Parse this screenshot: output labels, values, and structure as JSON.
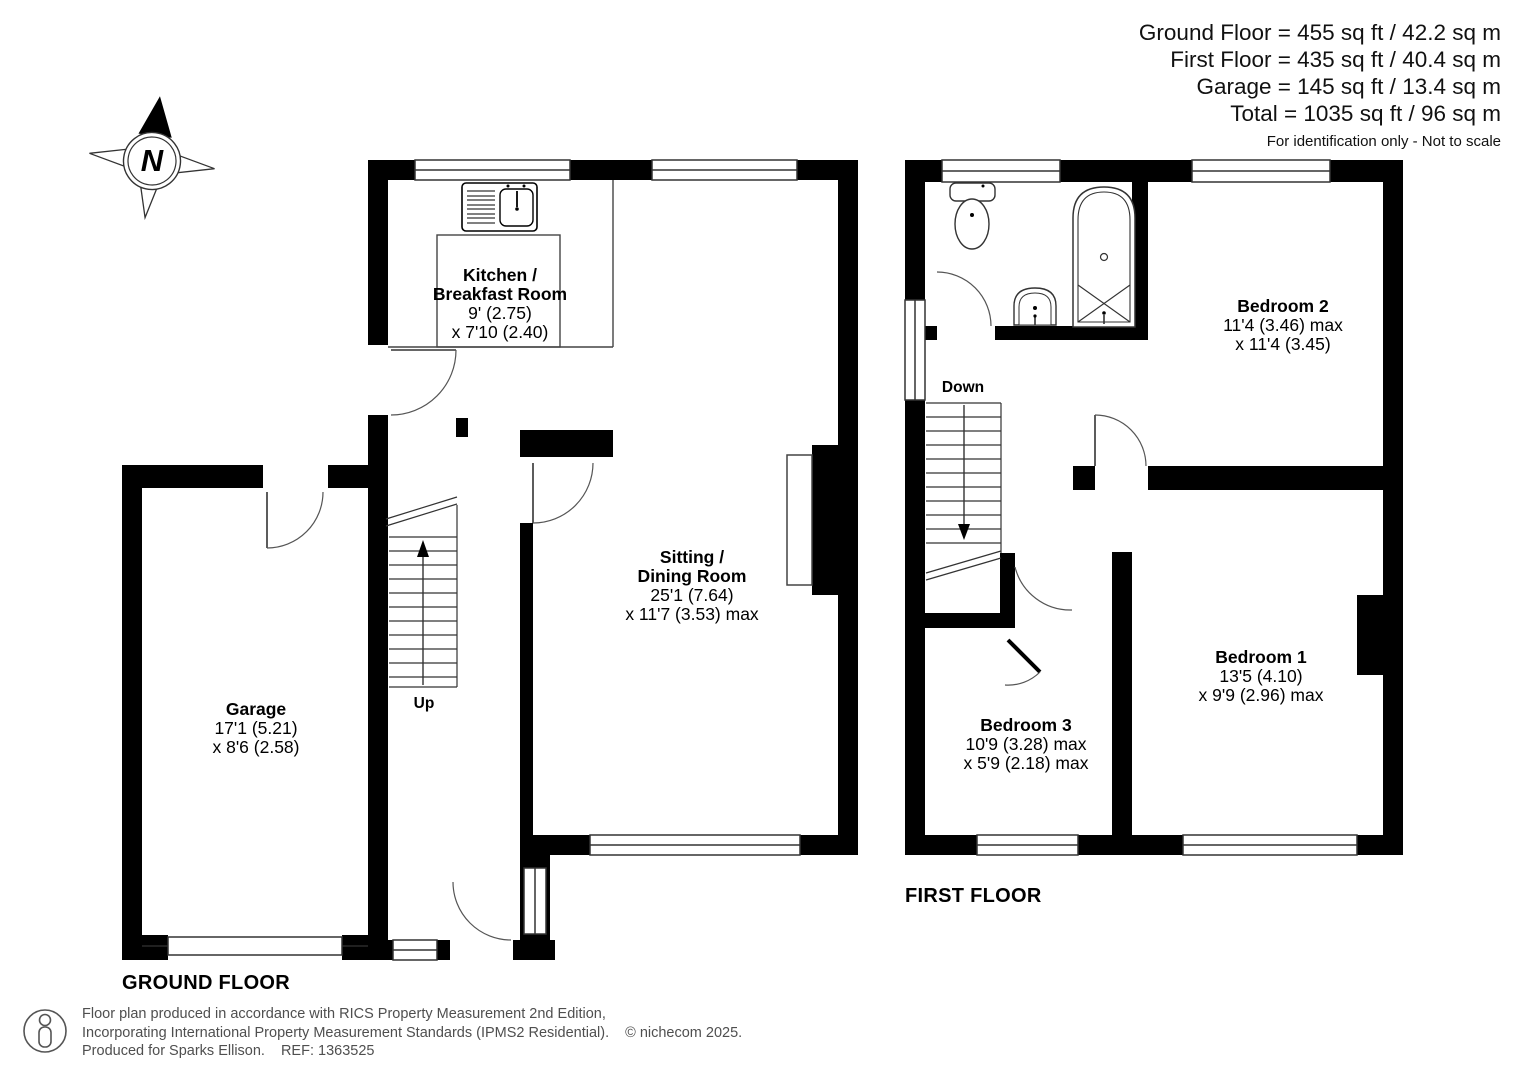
{
  "header": {
    "area_lines": [
      "Ground Floor = 455 sq ft / 42.2 sq m",
      "First Floor = 435 sq ft / 40.4 sq m",
      "Garage = 145 sq ft / 13.4 sq m",
      "Total = 1035 sq ft / 96 sq m"
    ],
    "disclaimer": "For identification only - Not to scale"
  },
  "compass": {
    "letter": "N"
  },
  "ground_floor": {
    "label": "GROUND FLOOR",
    "stairs_label": "Up",
    "rooms": {
      "kitchen": {
        "name_line1": "Kitchen /",
        "name_line2": "Breakfast Room",
        "dim_line1": "9' (2.75)",
        "dim_line2": "x 7'10 (2.40)"
      },
      "sitting": {
        "name_line1": "Sitting /",
        "name_line2": "Dining Room",
        "dim_line1": "25'1 (7.64)",
        "dim_line2": "x 11'7 (3.53) max"
      },
      "garage": {
        "name_line1": "Garage",
        "dim_line1": "17'1 (5.21)",
        "dim_line2": "x 8'6 (2.58)"
      }
    }
  },
  "first_floor": {
    "label": "FIRST FLOOR",
    "stairs_label": "Down",
    "rooms": {
      "bedroom1": {
        "name_line1": "Bedroom 1",
        "dim_line1": "13'5 (4.10)",
        "dim_line2": "x 9'9 (2.96) max"
      },
      "bedroom2": {
        "name_line1": "Bedroom 2",
        "dim_line1": "11'4 (3.46) max",
        "dim_line2": "x 11'4 (3.45)"
      },
      "bedroom3": {
        "name_line1": "Bedroom 3",
        "dim_line1": "10'9 (3.28) max",
        "dim_line2": "x 5'9 (2.18) max"
      }
    }
  },
  "footer": {
    "line1": "Floor plan produced in accordance with RICS Property Measurement 2nd Edition,",
    "line2": "Incorporating International Property Measurement Standards (IPMS2 Residential).",
    "copyright": "© nichecom 2025.",
    "line3": "Produced for Sparks Ellison.",
    "ref": "REF: 1363525"
  }
}
